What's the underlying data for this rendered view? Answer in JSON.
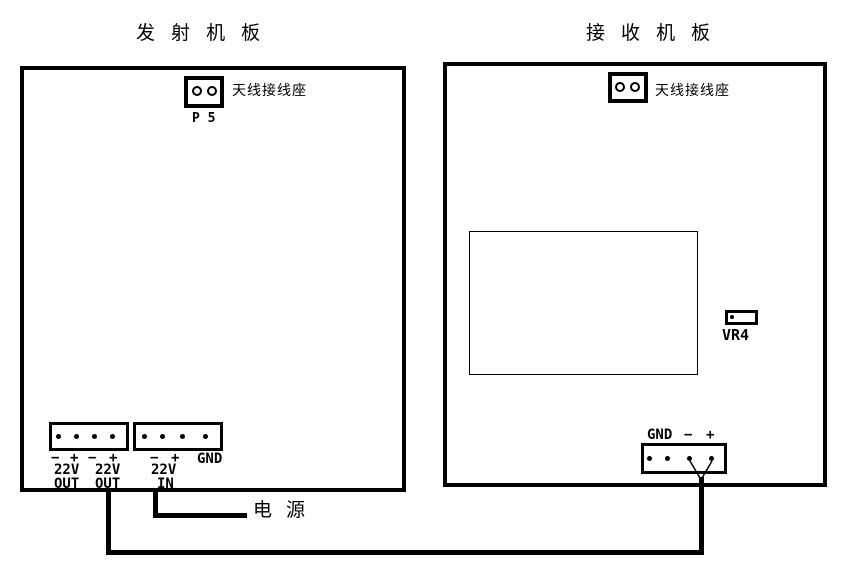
{
  "colors": {
    "ink": "#000000",
    "background": "#ffffff"
  },
  "transmitter_board": {
    "title": "发 射 机 板",
    "antenna_connector": {
      "label": "天线接线座",
      "designator": "P 5"
    },
    "output_connector": {
      "signs": [
        "−",
        "+",
        "−",
        "+"
      ],
      "volts": [
        "22V",
        "22V"
      ],
      "direction": [
        "OUT",
        "OUT"
      ]
    },
    "input_connector": {
      "signs": [
        "−",
        "+"
      ],
      "gnd": "GND",
      "volt": "22V",
      "direction": "IN"
    }
  },
  "receiver_board": {
    "title": "接 收 机 板",
    "antenna_connector": {
      "label": "天线接线座"
    },
    "trimmer": {
      "designator": "VR4"
    },
    "power_connector": {
      "gnd": "GND",
      "minus": "−",
      "plus": "+"
    }
  },
  "power_source_label": "电 源"
}
